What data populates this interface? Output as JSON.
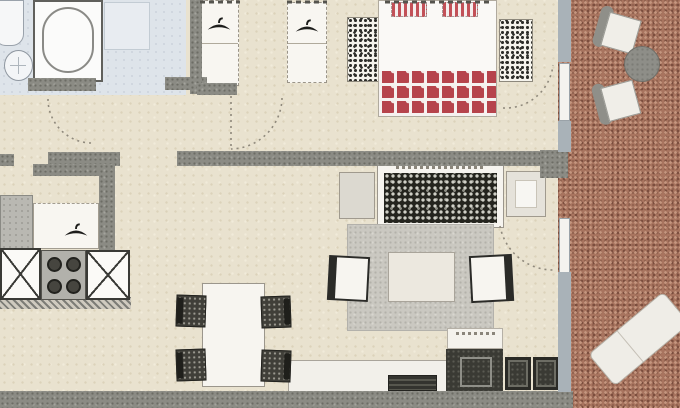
{
  "meta": {
    "title": "apartment-floor-plan",
    "type": "scanned architectural floor plan, top-down view, cropped at top and left edges",
    "legible_text": "none (only illegible scan marks / dimension squiggles)"
  },
  "colors": {
    "floor": "#e9e2cf",
    "floorDot": "#dcd2ba",
    "bath": "#dee4ea",
    "wall": "#8b8b84",
    "wallDot": "#6c6c65",
    "bwall": "#a9b2b8",
    "balcony": "#a8745f",
    "balconyDot1": "#c59780",
    "balconyDot2": "#7c4e3e",
    "rug": "#cac8c1",
    "rugDot": "#b3b1aa",
    "sofaDark": "#24241e",
    "sofaDot": "#cfcfc6",
    "dark": "#3a3a34",
    "chair": "#403f39",
    "red": "#b6434c"
  },
  "rooms": [
    {
      "id": "bathroom",
      "floor": "light-blue-tile",
      "furniture": [
        "toilet",
        "washbasin",
        "bathtub",
        "shower-tray"
      ],
      "doors": [
        "swing-door-to-hallway"
      ]
    },
    {
      "id": "bedroom-small",
      "floor": "beige",
      "furniture": [
        "wardrobe-with-hanger",
        "wardrobe-with-hanger-and-shelves"
      ],
      "doors": [
        "swing-door-from-hallway"
      ]
    },
    {
      "id": "bedroom-master",
      "floor": "beige",
      "furniture": [
        "dresser-left",
        "double-bed",
        "striped-pillow",
        "striped-pillow",
        "red-checkered-duvet",
        "dresser-right"
      ],
      "doors": [
        "balcony-door"
      ]
    },
    {
      "id": "hallway",
      "floor": "beige",
      "furniture": [
        "built-in-closet-with-hanger"
      ]
    },
    {
      "id": "kitchen",
      "floor": "beige",
      "furniture": [
        "tall-cabinet",
        "sink-base-unit",
        "cooktop-four-burners",
        "counter-unit"
      ]
    },
    {
      "id": "living-dining",
      "floor": "beige",
      "furniture": [
        "side-table-left",
        "sofa-dark-cushions",
        "side-table-right",
        "gray-rug",
        "coffee-table",
        "armchair-left",
        "armchair-right",
        "dining-table",
        "dining-chair",
        "dining-chair",
        "dining-chair",
        "dining-chair",
        "tv-bench",
        "tv",
        "media-cabinet",
        "stool",
        "stool",
        "wall-shelf"
      ],
      "doors": [
        "balcony-door"
      ]
    },
    {
      "id": "balcony",
      "floor": "terracotta",
      "furniture": [
        "patio-chair",
        "round-table",
        "patio-chair",
        "sun-lounger"
      ]
    }
  ],
  "door_arcs": 4,
  "icons": [
    "hanger-icon",
    "hanger-icon",
    "hanger-icon",
    "burner-icon"
  ]
}
